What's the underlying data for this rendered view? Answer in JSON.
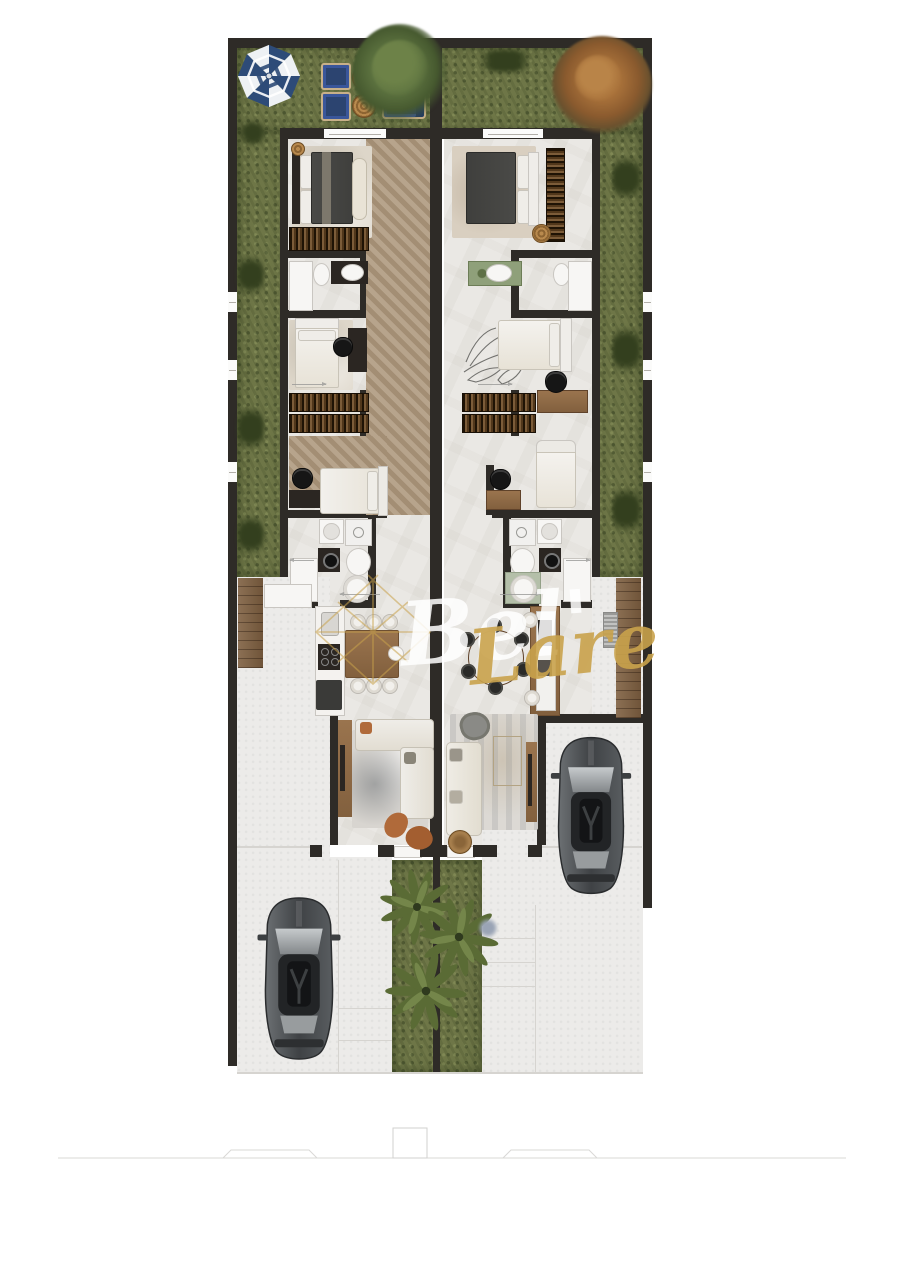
{
  "title": "Duplex residence floor plan (top-down render)",
  "watermark": {
    "part1": "Bel'",
    "part2": "Lare"
  },
  "palette": {
    "page_bg": "#ffffff",
    "wall": "#2e2b27",
    "floor_tile": "#eae8e4",
    "concrete": "#ecebe9",
    "grass": "#6d7546",
    "hedge": "#333f1e",
    "herringbone_wood": "#b29e86",
    "deck_wood": "#7f6041",
    "wardrobe_wood": "#51371b",
    "navy_outdoor_furniture": "#2c4470",
    "rattan": "#b9894e",
    "dark_duvet": "#3b3b39",
    "cream_fabric": "#e9e3d6",
    "rust_accent": "#b06a3a",
    "tree_green": "#4f6233",
    "tree_autumn": "#96602f",
    "car_body": "#45484a",
    "watermark_gold": "#c9a24b",
    "watermark_white": "#ffffff"
  },
  "legend": {
    "units": 2,
    "bedrooms_per_unit": 3,
    "cars": 2,
    "palm_trees": 3,
    "objects": [
      "patio-umbrella",
      "outdoor-lounge-chairs",
      "rattan-side-tables",
      "outdoor-sofa",
      "green-tree",
      "autumn-tree",
      "master-bed",
      "wardrobe",
      "bathroom-vanity",
      "shower",
      "toilet",
      "washing-machine",
      "bathtub",
      "single-bed",
      "desk",
      "office-chair",
      "kitchen-counter",
      "dining-table",
      "dining-chairs",
      "sofa",
      "armchair",
      "tv-panel",
      "rug",
      "car",
      "palm-tree",
      "driveway",
      "deck-walkway",
      "ac-unit",
      "street-curb",
      "gate-pillar"
    ]
  }
}
